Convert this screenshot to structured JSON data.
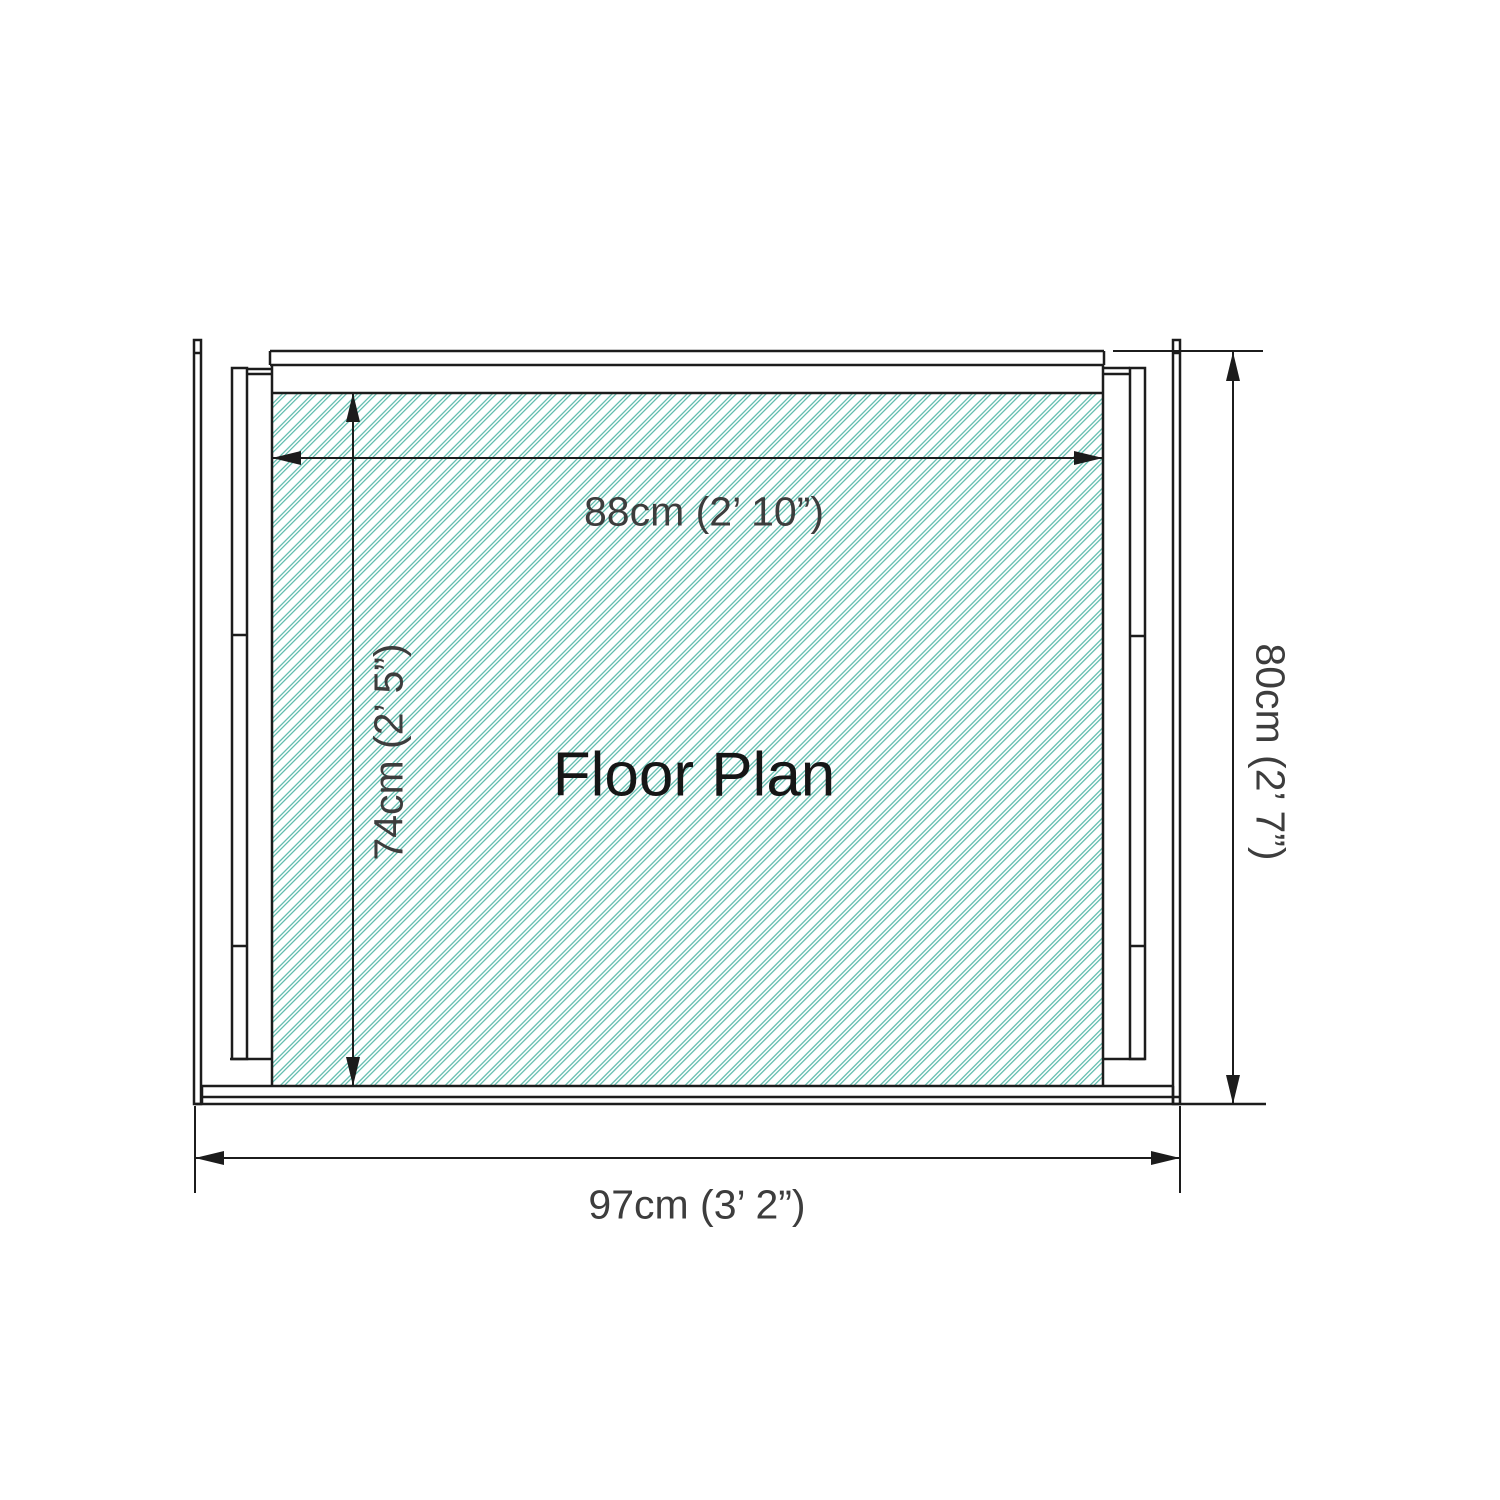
{
  "diagram": {
    "title": "Floor Plan",
    "type": "shed-floor-plan",
    "dimensions": {
      "inner_width": {
        "cm": 88,
        "imperial": "2’ 10”",
        "label": "88cm (2’ 10”)"
      },
      "inner_depth": {
        "cm": 74,
        "imperial": "2’ 5”",
        "label": "74cm (2’ 5”)"
      },
      "outer_depth": {
        "cm": 80,
        "imperial": "2’ 7”",
        "label": "80cm (2’ 7”)"
      },
      "outer_width": {
        "cm": 97,
        "imperial": "3’ 2”",
        "label": "97cm (3’ 2”)"
      }
    },
    "colors": {
      "hatch_teal": "#4fb5a5",
      "wall_lines": "#1c1c1c",
      "dimension_text": "#3d3d3d",
      "background": "#ffffff"
    }
  }
}
